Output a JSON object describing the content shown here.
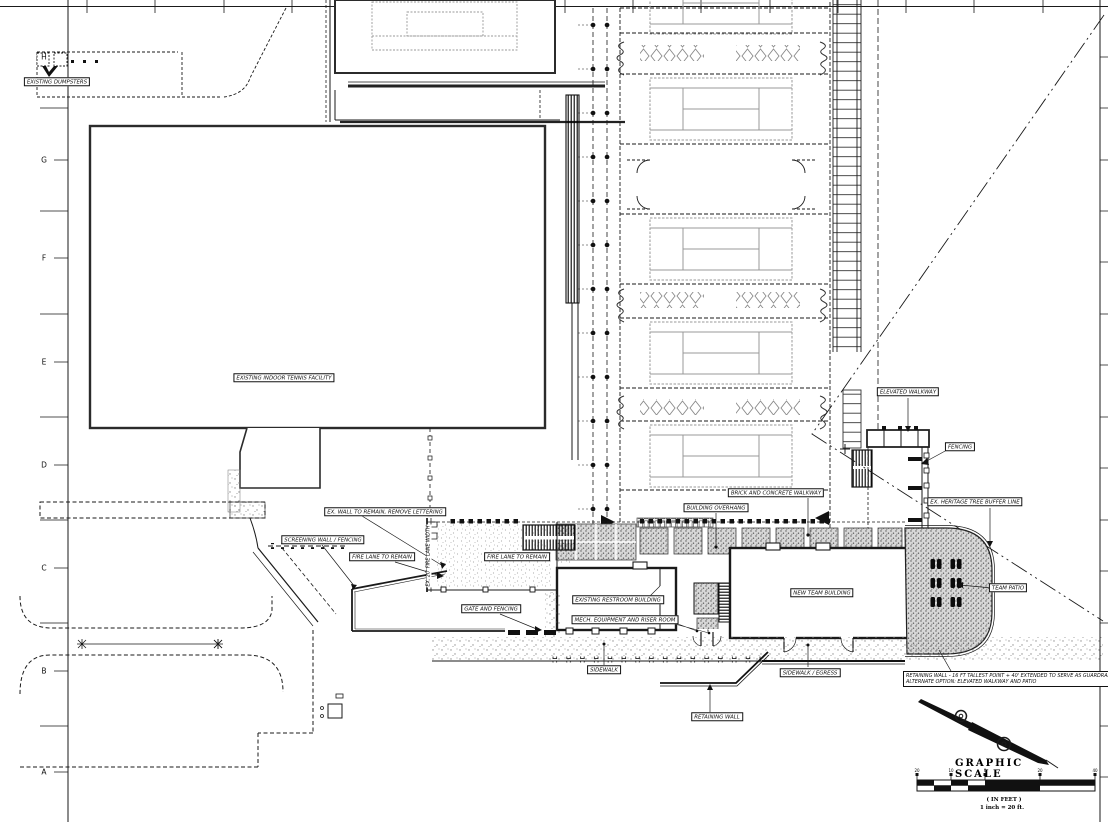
{
  "grid": {
    "rows": [
      "H",
      "G",
      "F",
      "E",
      "D",
      "C",
      "B",
      "A"
    ]
  },
  "labels": {
    "existing_dumpsters": "EXISTING DUMPSTERS",
    "indoor_tennis": "EXISTING INDOOR TENNIS FACILITY",
    "elevated_walkway": "ELEVATED WALKWAY",
    "fencing": "FENCING",
    "heritage_tree": "EX. HERITAGE TREE BUFFER LINE",
    "brick_walkway": "BRICK AND CONCRETE WALKWAY",
    "building_overhang": "BUILDING OVERHANG",
    "ex_wall": "EX. WALL TO REMAIN, REMOVE LETTERING",
    "screening_wall": "SCREENING WALL / FENCING",
    "fire_lane_left": "FIRE LANE TO REMAIN",
    "fire_lane_right": "FIRE LANE TO REMAIN",
    "fire_lane_width": "EX. 20' FIRE LANE WIDTH",
    "gate_fencing": "GATE AND FENCING",
    "restroom": "EXISTING RESTROOM BUILDING",
    "mech": "MECH. EQUIPMENT AND RISER ROOM",
    "new_team": "NEW TEAM BUILDING",
    "team_patio": "TEAM PATIO",
    "sidewalk": "SIDEWALK",
    "sidewalk_egress": "SIDEWALK / EGRESS",
    "retaining_wall": "RETAINING WALL",
    "retaining_alt_1": "RETAINING WALL - 16 FT TALLEST POINT + 40' EXTENDED  TO SERVE AS GUARDRAIL",
    "retaining_alt_2": "ALTERNATE OPTION: ELEVATED WALKWAY AND PATIO"
  },
  "scale": {
    "title": "GRAPHIC SCALE",
    "units_note": "( IN FEET )",
    "ratio_note": "1 inch = 20 ft.",
    "tick_labels": [
      "20",
      "10",
      "0",
      "20",
      "40"
    ]
  },
  "colors": {
    "line": "#1a1a1a",
    "court_line": "#999999",
    "paver_fill": "#d4d4d4"
  }
}
